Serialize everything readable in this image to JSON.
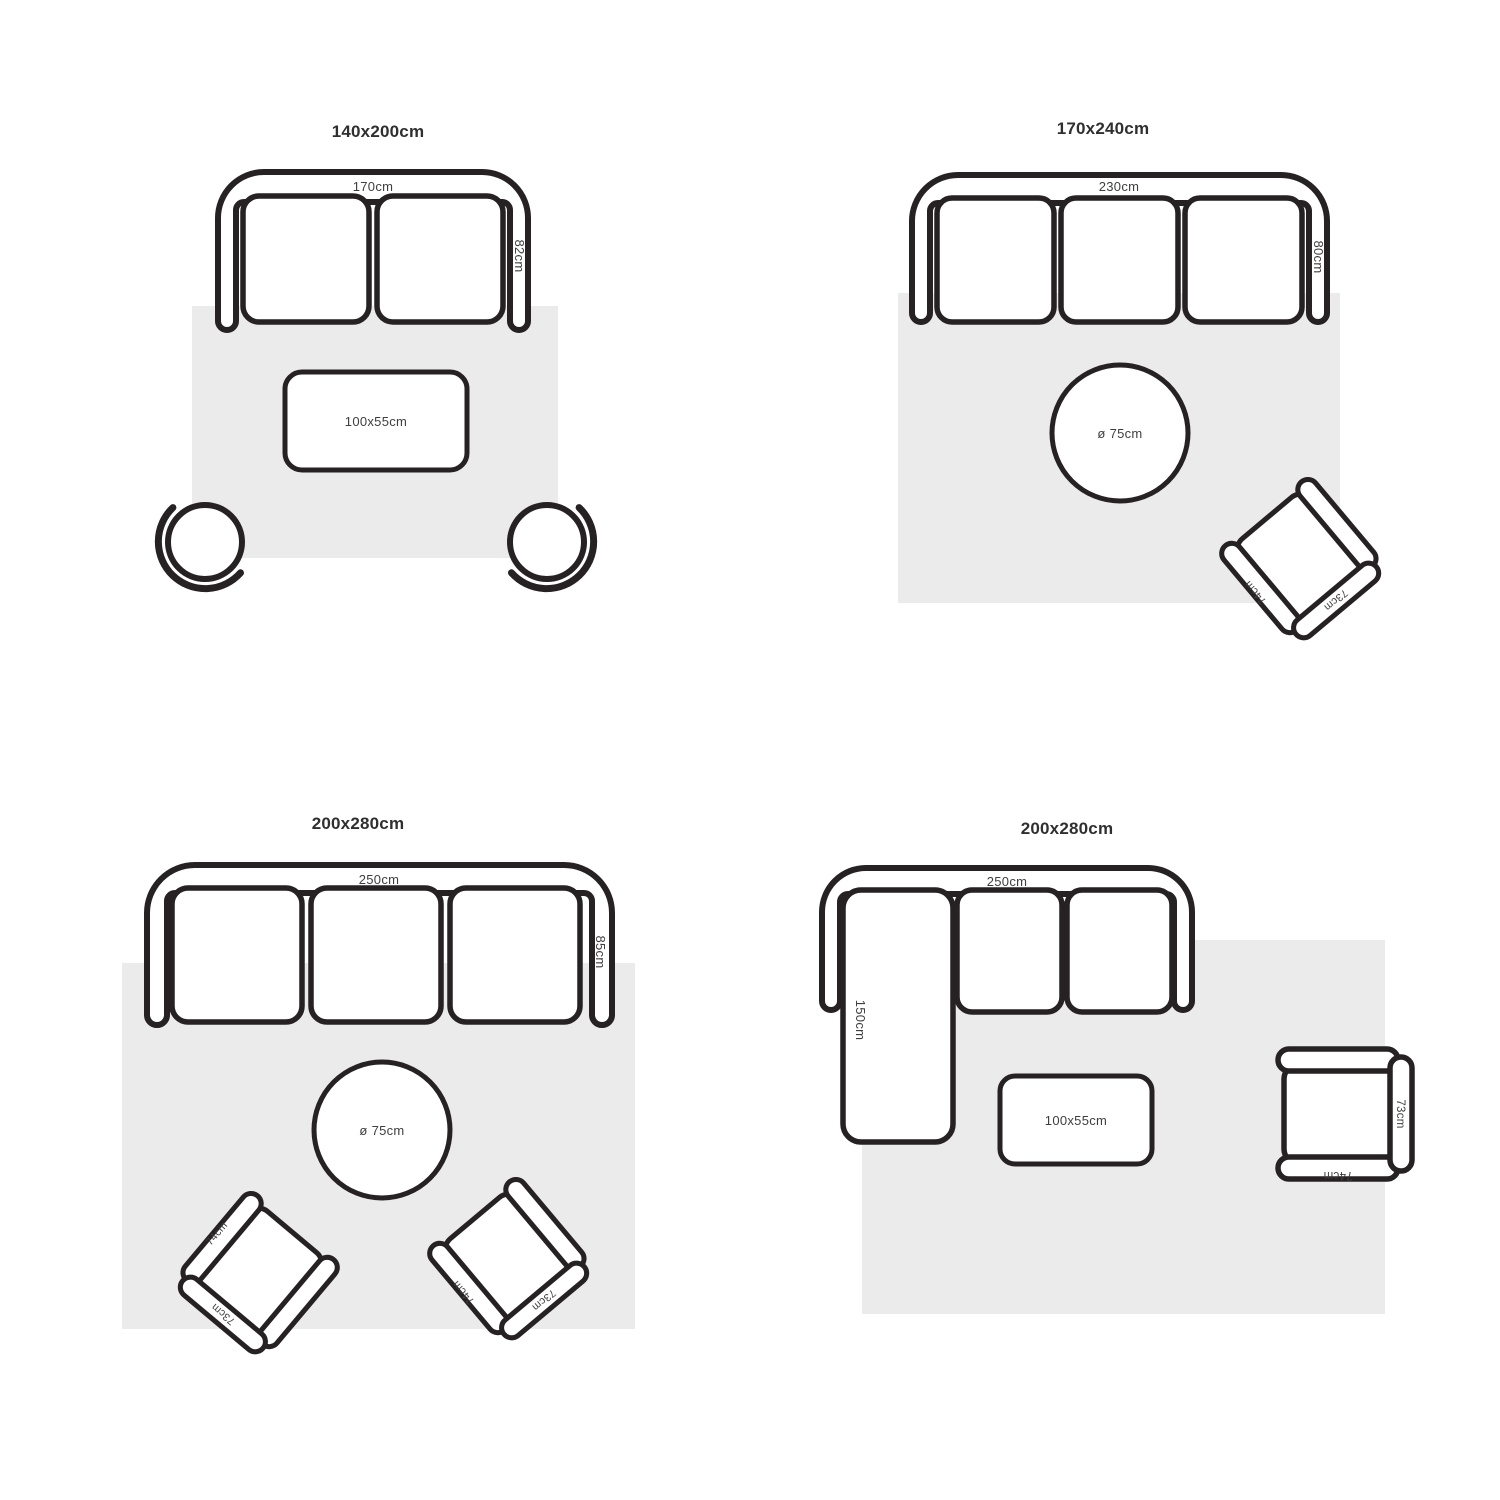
{
  "colors": {
    "background": "#ffffff",
    "outline": "#262122",
    "rug": "#ECEBEB",
    "label": "#3e3e3e",
    "title": "#2f2f2f"
  },
  "quadrants": {
    "q1": {
      "title": "140x200cm",
      "sofa_width": "170cm",
      "sofa_depth": "82cm",
      "coffee_table": "100x55cm"
    },
    "q2": {
      "title": "170x240cm",
      "sofa_width": "230cm",
      "sofa_depth": "80cm",
      "round_table": "ø 75cm",
      "chair_arm": "74cm",
      "chair_back": "73cm"
    },
    "q3": {
      "title": "200x280cm",
      "sofa_width": "250cm",
      "sofa_depth": "85cm",
      "round_table": "ø 75cm",
      "chair_left_arm": "74cm",
      "chair_left_back": "73cm",
      "chair_right_arm": "74cm",
      "chair_right_back": "73cm"
    },
    "q4": {
      "title": "200x280cm",
      "sofa_width": "250cm",
      "chaise_length": "150cm",
      "coffee_table": "100x55cm",
      "chair_back": "73cm",
      "chair_arm": "74cm"
    }
  }
}
